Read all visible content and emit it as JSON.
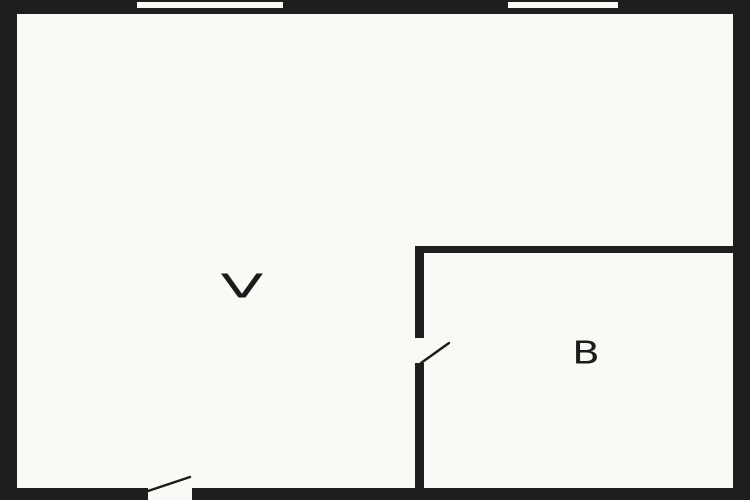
{
  "palette": {
    "wall": "#201d1e",
    "floor": "#fbf9f5",
    "ink": "#1c1a1b"
  },
  "rooms": [
    {
      "label": "V"
    },
    {
      "label": "B"
    }
  ],
  "features": {
    "windows": [
      {
        "name": "window-top-left"
      },
      {
        "name": "window-top-right"
      }
    ],
    "doors": [
      {
        "name": "exterior-door-bottom"
      },
      {
        "name": "room-b-door"
      }
    ]
  }
}
